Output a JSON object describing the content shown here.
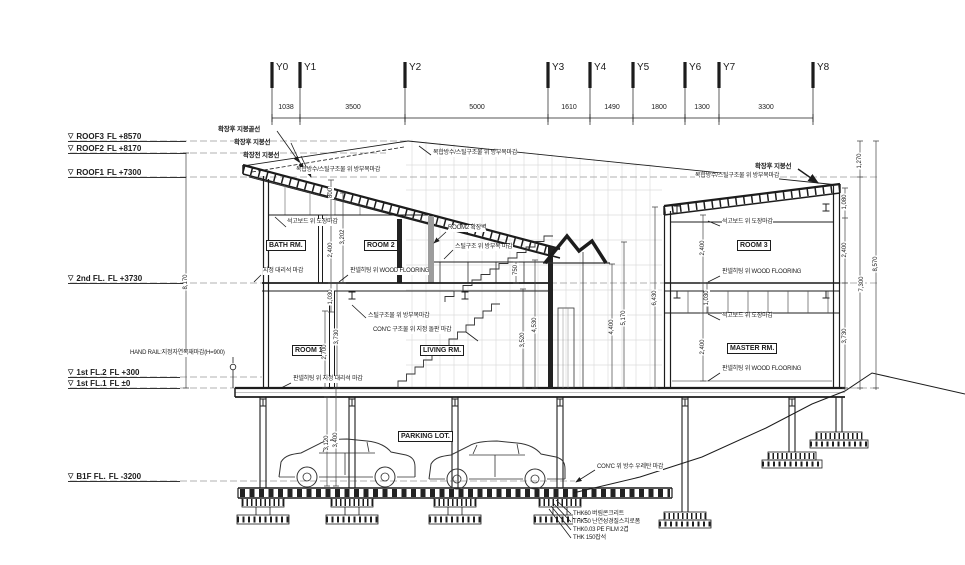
{
  "grid": {
    "labels": [
      "Y0",
      "Y1",
      "Y2",
      "Y3",
      "Y4",
      "Y5",
      "Y6",
      "Y7",
      "Y8"
    ],
    "spans": [
      "1038",
      "3500",
      "5000",
      "1610",
      "1490",
      "1800",
      "1300",
      "3300"
    ]
  },
  "levels": {
    "marker": "▽",
    "items": [
      {
        "name": "ROOF3",
        "elev": "FL +8570"
      },
      {
        "name": "ROOF2",
        "elev": "FL +8170"
      },
      {
        "name": "ROOF1",
        "elev": "FL +7300"
      },
      {
        "name": "2nd FL.",
        "elev": "FL +3730"
      },
      {
        "name": "1st FL.2",
        "elev": "FL +300"
      },
      {
        "name": "1st FL.1",
        "elev": "FL ±0"
      },
      {
        "name": "B1F FL.",
        "elev": "FL -3200"
      }
    ]
  },
  "rooms": {
    "bath": "BATH RM.",
    "room2": "ROOM 2",
    "room1": "ROOM 1",
    "living": "LIVING RM.",
    "room3": "ROOM 3",
    "master": "MASTER RM.",
    "parking": "PARKING LOT."
  },
  "callouts": {
    "roof_ridge_after": "확장후 지붕골선",
    "roof_after": "확장후 지붕선",
    "roof_before": "확장전 지붕선",
    "steel_wood": "복합방수/스틸구조물 위 방부목마감",
    "gypsum_paint": "석고보드 위 도장마감",
    "room2_ext": "ROOM2 확장벽",
    "stair_steel_wood": "스틸구조 위 방부목 마감",
    "marble": "지정 대리석 마감",
    "panel_wood": "판넬히팅 위 WOOD FLOORING",
    "steel_wood_mid": "스틸구조물 위 방부목마감",
    "conc_stone": "CON'C 구조물 위 지정 돌판 마감",
    "panel_marble": "판넬히팅 위 지정 대리석 마감",
    "handrail": "HAND RAIL:지정자연목재마감(H=900)",
    "conc_urethane": "CON'C 위 방수 우레탄 마감",
    "b1f_layers": [
      "THK60 버림콘크리트",
      "THK50 난연성경질스치로폼",
      "THK0.03 PE FILM 2겹",
      "THK 150잡석"
    ]
  },
  "vdims": {
    "left_8170": "8,170",
    "w800": "800",
    "w3202": "3,202",
    "w2400": "2,400",
    "w1030": "1,030",
    "f2700": "2,700",
    "f3730": "3,730",
    "stair_750": "750",
    "stair_3520": "3,520",
    "stair_4530": "4,530",
    "stair_4400": "4,400",
    "stair_5170": "5,170",
    "mid_6430": "6,430",
    "r_2400a": "2,400",
    "r_1030": "1,030",
    "r_2400b": "2,400",
    "chain_1080": "1,080",
    "chain_2400": "2,400",
    "chain_3730": "3,730",
    "col_1270": "1,270",
    "col_7300": "7,300",
    "total_8570": "8,570",
    "park_3120": "3,120",
    "park_3400": "3,400"
  },
  "colors": {
    "background": "#ffffff",
    "line": "#1c1c1c",
    "dim_line": "#444444",
    "faint_grid": "#dddddd",
    "gray_wall": "#9c9c9c"
  }
}
